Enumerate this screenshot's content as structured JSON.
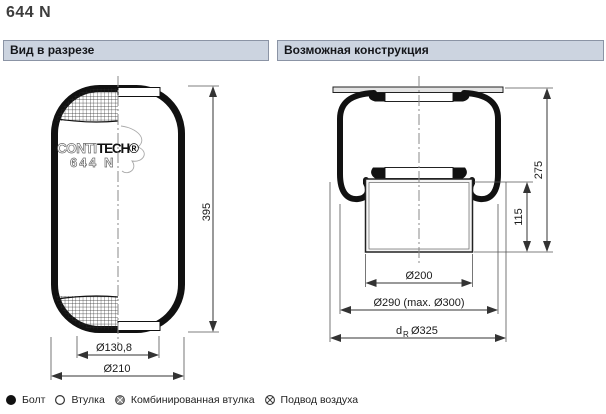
{
  "page": {
    "title": "644 N"
  },
  "panels": {
    "left": {
      "header": "Вид в разрезе"
    },
    "right": {
      "header": "Возможная конструкция"
    }
  },
  "left_figure": {
    "logo_outline": "CONTI",
    "logo_solid": "TECH®",
    "logo_line2": "644 N",
    "dim_height": "395",
    "dim_bead_dia": "Ø130,8",
    "dim_outer_dia": "Ø210"
  },
  "right_figure": {
    "dim_total_height": "275",
    "dim_piston_height": "115",
    "dim_piston_dia": "Ø200",
    "dim_plate_dia": "Ø290 (max. Ø300)",
    "dim_rim_prefix": "d",
    "dim_rim_sub": "R",
    "dim_rim_value": "Ø325"
  },
  "legend": {
    "items": [
      {
        "symbol": "bolt-icon",
        "label": "Болт"
      },
      {
        "symbol": "bushing-icon",
        "label": "Втулка"
      },
      {
        "symbol": "combined-bushing-icon",
        "label": "Комбинированная втулка"
      },
      {
        "symbol": "air-supply-icon",
        "label": "Подвод воздуха"
      }
    ]
  },
  "colors": {
    "header_bg": "#ccd4e0",
    "header_border": "#8b94a5",
    "line": "#1a1a1a"
  }
}
